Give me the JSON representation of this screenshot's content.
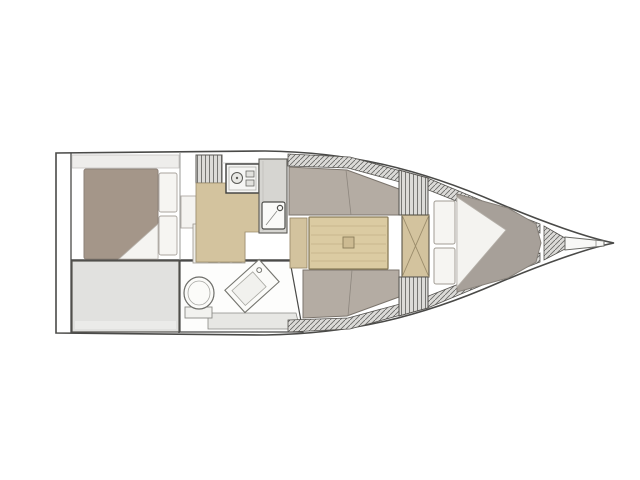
{
  "figure": {
    "type": "sailboat-interior-floor-plan",
    "orientation": "bow-right",
    "background": "#ffffff"
  },
  "palette": {
    "outline": "#4a4a48",
    "line-soft": "#9a9a96",
    "white-soft": "#f6f5f2",
    "floor-gray": "#e1e1df",
    "settee": "#b4aca3",
    "aft-bed": "#a49689",
    "v-bed": "#a7a099",
    "wood": "#d3c39e",
    "table-wood": "#dbcba2",
    "step-wood": "#cdbb92",
    "counter-gray": "#d6d5d1",
    "hatch-bg": "#dcdbd8",
    "hatch-line": "#6a6a68"
  },
  "elements": [
    {
      "name": "hull-outline",
      "kind": "boundary"
    },
    {
      "name": "transom",
      "kind": "wall"
    },
    {
      "name": "aft-cabin-bed",
      "kind": "berth"
    },
    {
      "name": "aft-cabin-pillows",
      "kind": "cushion"
    },
    {
      "name": "aft-utility-area",
      "kind": "compartment"
    },
    {
      "name": "head-compartment",
      "kind": "bathroom"
    },
    {
      "name": "toilet",
      "kind": "fixture"
    },
    {
      "name": "head-sink",
      "kind": "fixture"
    },
    {
      "name": "companionway-steps",
      "kind": "stairs"
    },
    {
      "name": "galley-stove",
      "kind": "appliance"
    },
    {
      "name": "galley-sink",
      "kind": "fixture"
    },
    {
      "name": "galley-counter",
      "kind": "furniture"
    },
    {
      "name": "salon-settee-port",
      "kind": "seating"
    },
    {
      "name": "salon-settee-starboard",
      "kind": "seating"
    },
    {
      "name": "salon-table",
      "kind": "furniture"
    },
    {
      "name": "forward-bulkhead-door",
      "kind": "door"
    },
    {
      "name": "v-berth-bed",
      "kind": "berth"
    },
    {
      "name": "anchor-locker",
      "kind": "compartment"
    },
    {
      "name": "bow-stem",
      "kind": "structure"
    }
  ]
}
